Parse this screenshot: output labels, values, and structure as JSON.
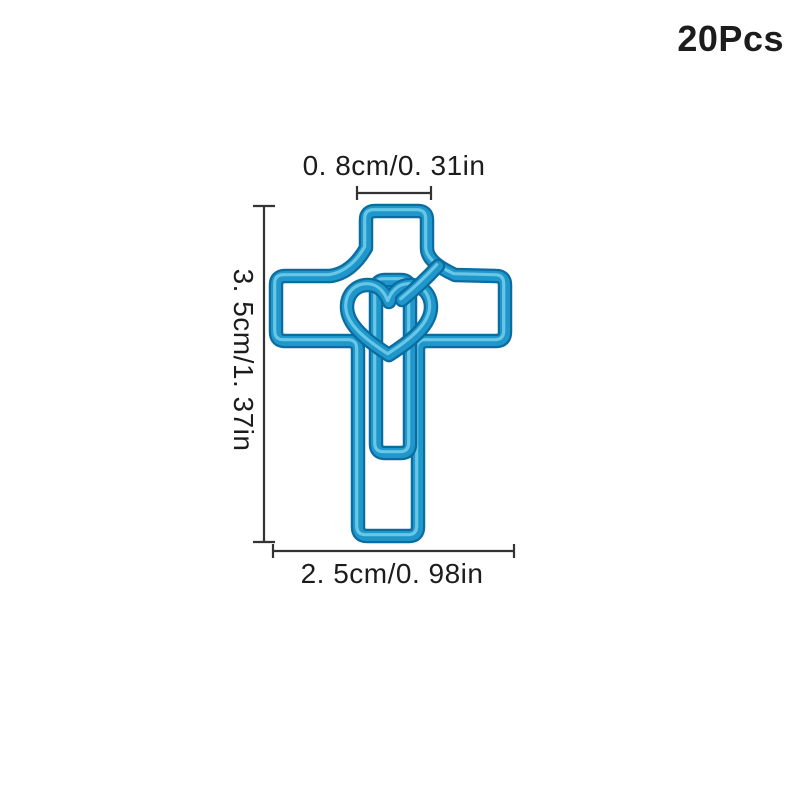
{
  "page": {
    "background_color": "#ffffff"
  },
  "product": {
    "name": "blue cross heart paper clip",
    "quantity_label": "20Pcs",
    "wire_colors": {
      "dark": "#0B6CA0",
      "main": "#1F97CB",
      "highlight": "#70CBE9"
    }
  },
  "dimensions": {
    "top_width": "0. 8cm/0. 31in",
    "side_height": "3. 5cm/1. 37in",
    "bottom_width": "2. 5cm/0. 98in"
  },
  "annotations": {
    "line_color": "#333333",
    "text_color": "#1C1C1C"
  }
}
